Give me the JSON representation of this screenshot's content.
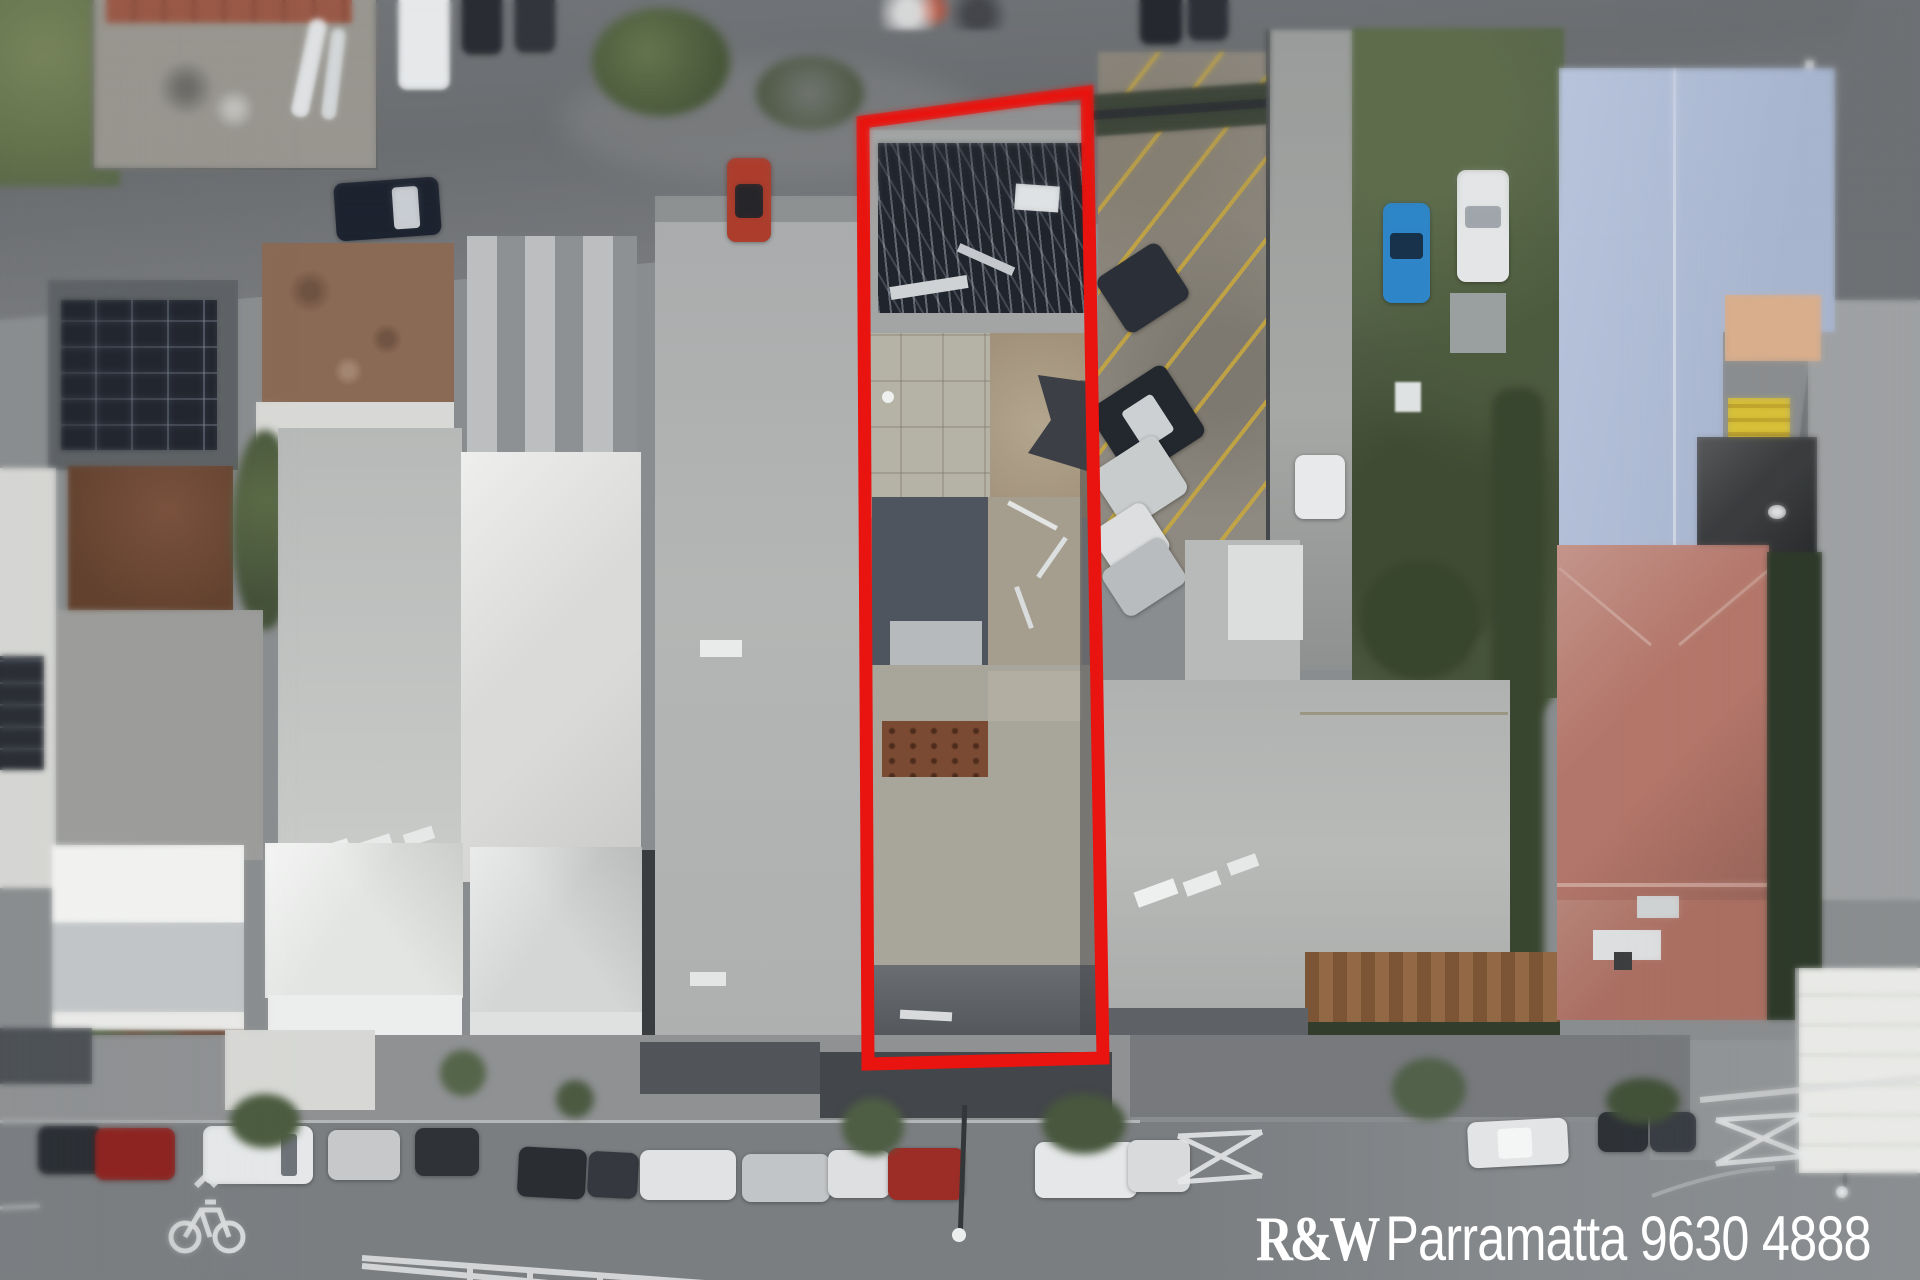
{
  "image": {
    "kind": "aerial-drone-photograph",
    "width_px": 1920,
    "height_px": 1280
  },
  "watermark": {
    "brand": "R&W",
    "office": "Parramatta",
    "phone": "9630 4888",
    "color": "#ffffff"
  },
  "boundary": {
    "color": "#e9140f",
    "stroke_width": 13,
    "points": "863,122 1087,92 1103,1058 868,1064",
    "meaning": "highlighted-property-lot-outline"
  },
  "colors": {
    "asphalt_dark": "#6f7275",
    "asphalt_light": "#85888b",
    "roof_grey": "#b2b4b3",
    "roof_white": "#dadbd8",
    "roof_blue": "#aebcd6",
    "roof_salmon": "#b3766a",
    "roof_rust": "#7b4a33",
    "parking_line_yellow": "#c9a83c",
    "grass_green": "#5c6b4a",
    "marking_white": "#e6e8e9"
  },
  "scene": {
    "description": "Top-down aerial photo of a long narrow commercial lot outlined in red, between neighbouring shop roofs, a striped car park, a large warehouse roof, terrace houses and a main street with parked cars",
    "regions": [
      "top-road",
      "top-left-grass",
      "top-left-yard",
      "solar-panel-roof",
      "gravel-brown-roof",
      "striped-roof",
      "rust-courtyard",
      "grey-yard",
      "pale-long-roof",
      "white-hip-roof",
      "long-grey-roof",
      "outlined-property",
      "materials-pile",
      "concrete-yard",
      "car-park-yellow-stripes",
      "laneway",
      "garden-strip",
      "blue-hatchback",
      "big-blue-roof",
      "salmon-hip-roof",
      "warehouse-roof",
      "timber-pergola",
      "main-street",
      "parked-car-row",
      "bike-lane-symbol",
      "painted-traffic-island",
      "pedestrian-x-barriers",
      "street-trees",
      "white-corner-building",
      "watermark"
    ]
  }
}
